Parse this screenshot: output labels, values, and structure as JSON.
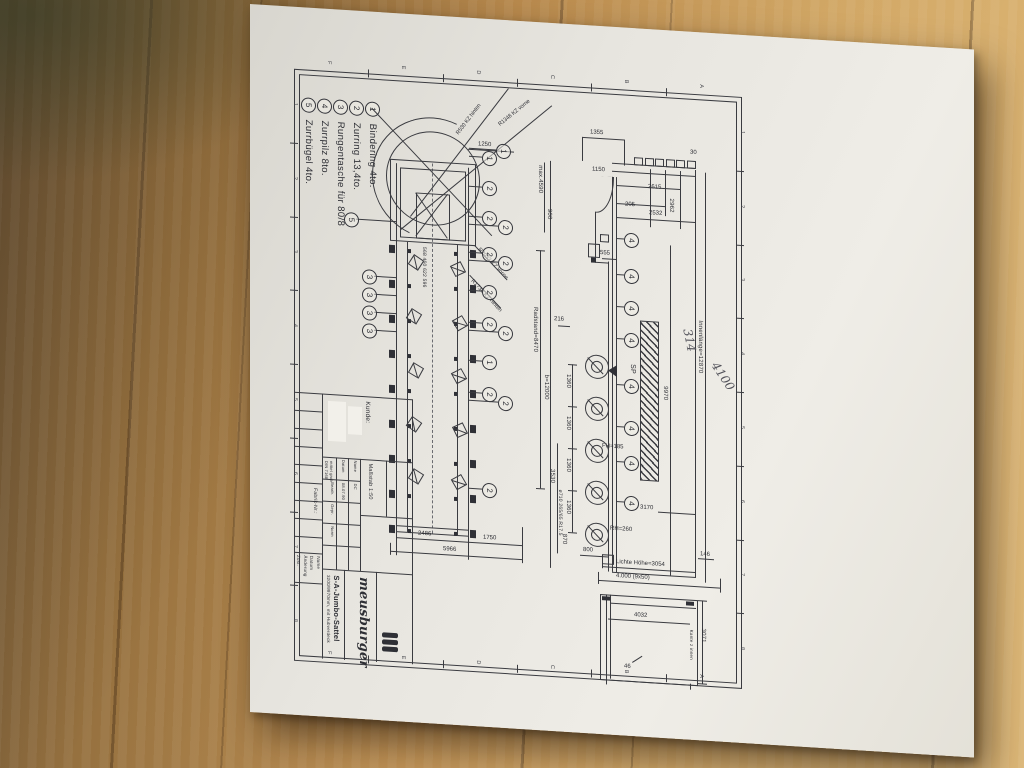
{
  "legend": {
    "items": [
      {
        "num": "1",
        "label": "Bindering 4to."
      },
      {
        "num": "2",
        "label": "Zurring 13,4to."
      },
      {
        "num": "3",
        "label": "Rungentasche für 80/8"
      },
      {
        "num": "4",
        "label": "Zurrpilz 8to."
      },
      {
        "num": "5",
        "label": "Zurrbügel 4to."
      }
    ]
  },
  "plan_view": {
    "dims": {
      "d1250": "1250",
      "d2486": "2486",
      "d1750": "1750",
      "d5966": "5966",
      "pocket_spacing": "568  460  622  596"
    },
    "radius_labels": {
      "r530": "R530 KZ hinten",
      "r1348": "R1348 KZ vorne",
      "r2033": "R2033 KZ vorne",
      "r1736": "R1736 KZ hinten"
    }
  },
  "side_view": {
    "dims": {
      "d1355": "1355",
      "d30": "30",
      "d1150": "1150",
      "d2615": "2615",
      "d205": "205",
      "d2532": "2532",
      "d2962": "2962",
      "d555": "555",
      "d216": "216",
      "max_height": "max.4590",
      "d900": "900",
      "d9970": "9970",
      "inner_length": "Innenlänge=12870",
      "wheelbase": "Radstand=8470",
      "total_length": "b=12000",
      "d3530": "3530",
      "d870": "870",
      "d800": "800",
      "axle_spacing": "1360",
      "fifth_wheel": "FH=185",
      "rear_height": "RH=260",
      "d3170": "3170",
      "d146": "146",
      "clear_height": "Lichte Höhe=3054",
      "d4000": "4.000 (9x50)",
      "tyre": "ø710 265/65 R17.5",
      "sp": "SP"
    }
  },
  "rear_view": {
    "dims": {
      "d4032": "4032",
      "d3071": "3071",
      "d46": "46",
      "note": "Kante z innen"
    }
  },
  "callouts": {
    "plan_right": [
      "1",
      "1",
      "2",
      "2",
      "2",
      "2",
      "2",
      "2",
      "2",
      "2",
      "1",
      "2",
      "2",
      "2"
    ],
    "plan_left": [
      "5",
      "3",
      "3",
      "3",
      "3"
    ],
    "side": [
      "4",
      "4",
      "4",
      "4",
      "4",
      "4",
      "4",
      "4"
    ]
  },
  "frame": {
    "numbers": [
      "1",
      "2",
      "3",
      "4",
      "5",
      "6",
      "7",
      "8"
    ],
    "letters": [
      "F",
      "E",
      "D",
      "C",
      "B",
      "A"
    ]
  },
  "handwritten": {
    "note1": "314",
    "note2": "4100"
  },
  "title_block": {
    "customer_label": "Kunde:",
    "factory_label": "Fabrik-Nr.:",
    "company": "meusburger",
    "product": "S-A-Jumbo-Sattel",
    "subtitle": "3200/9970mm, mit Hubverdeck",
    "scale": "Maßstab 1:50",
    "tolerance1": "DIN 7168",
    "tolerance2": "mittel grob",
    "col_datum": "Datum",
    "col_name": "Name",
    "row_bearb": "Bearb.",
    "row_gepr": "Gepr.",
    "row_norm": "Norm",
    "date": "08.07.90",
    "initials": "DC",
    "rev_zust": "Zust.",
    "rev_aenderung": "Änderung",
    "rev_datum": "Datum",
    "rev_name": "Name"
  }
}
